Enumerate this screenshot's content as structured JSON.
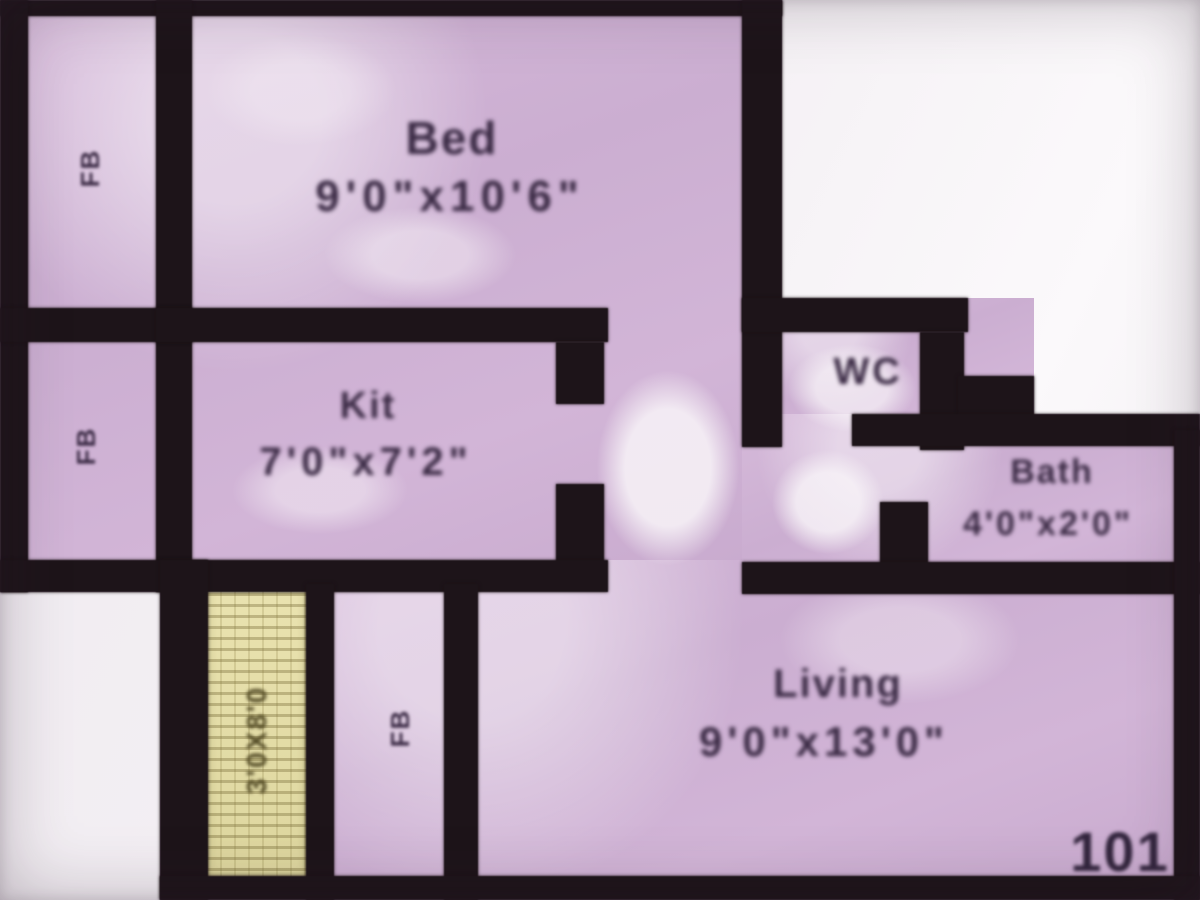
{
  "plan": {
    "unit_number": "101",
    "rooms": {
      "bed": {
        "name": "Bed",
        "dim": "9'0\"x10'6\""
      },
      "kitchen": {
        "name": "Kit",
        "dim": "7'0\"x7'2\""
      },
      "wc": {
        "name": "WC"
      },
      "bath": {
        "name": "Bath",
        "dim": "4'0\"x2'0\""
      },
      "living": {
        "name": "Living",
        "dim": "9'0\"x13'0\""
      },
      "terrace": {
        "dim": "3'0X8'0"
      }
    },
    "flower_bed_labels": [
      "FB",
      "FB",
      "FB"
    ],
    "colors": {
      "wall": "#1d1419",
      "room_fill": "#cfb2d4",
      "terrace_fill": "#e3dca6",
      "outside": "#f2eef2",
      "label_text": "#3a2a44"
    }
  }
}
